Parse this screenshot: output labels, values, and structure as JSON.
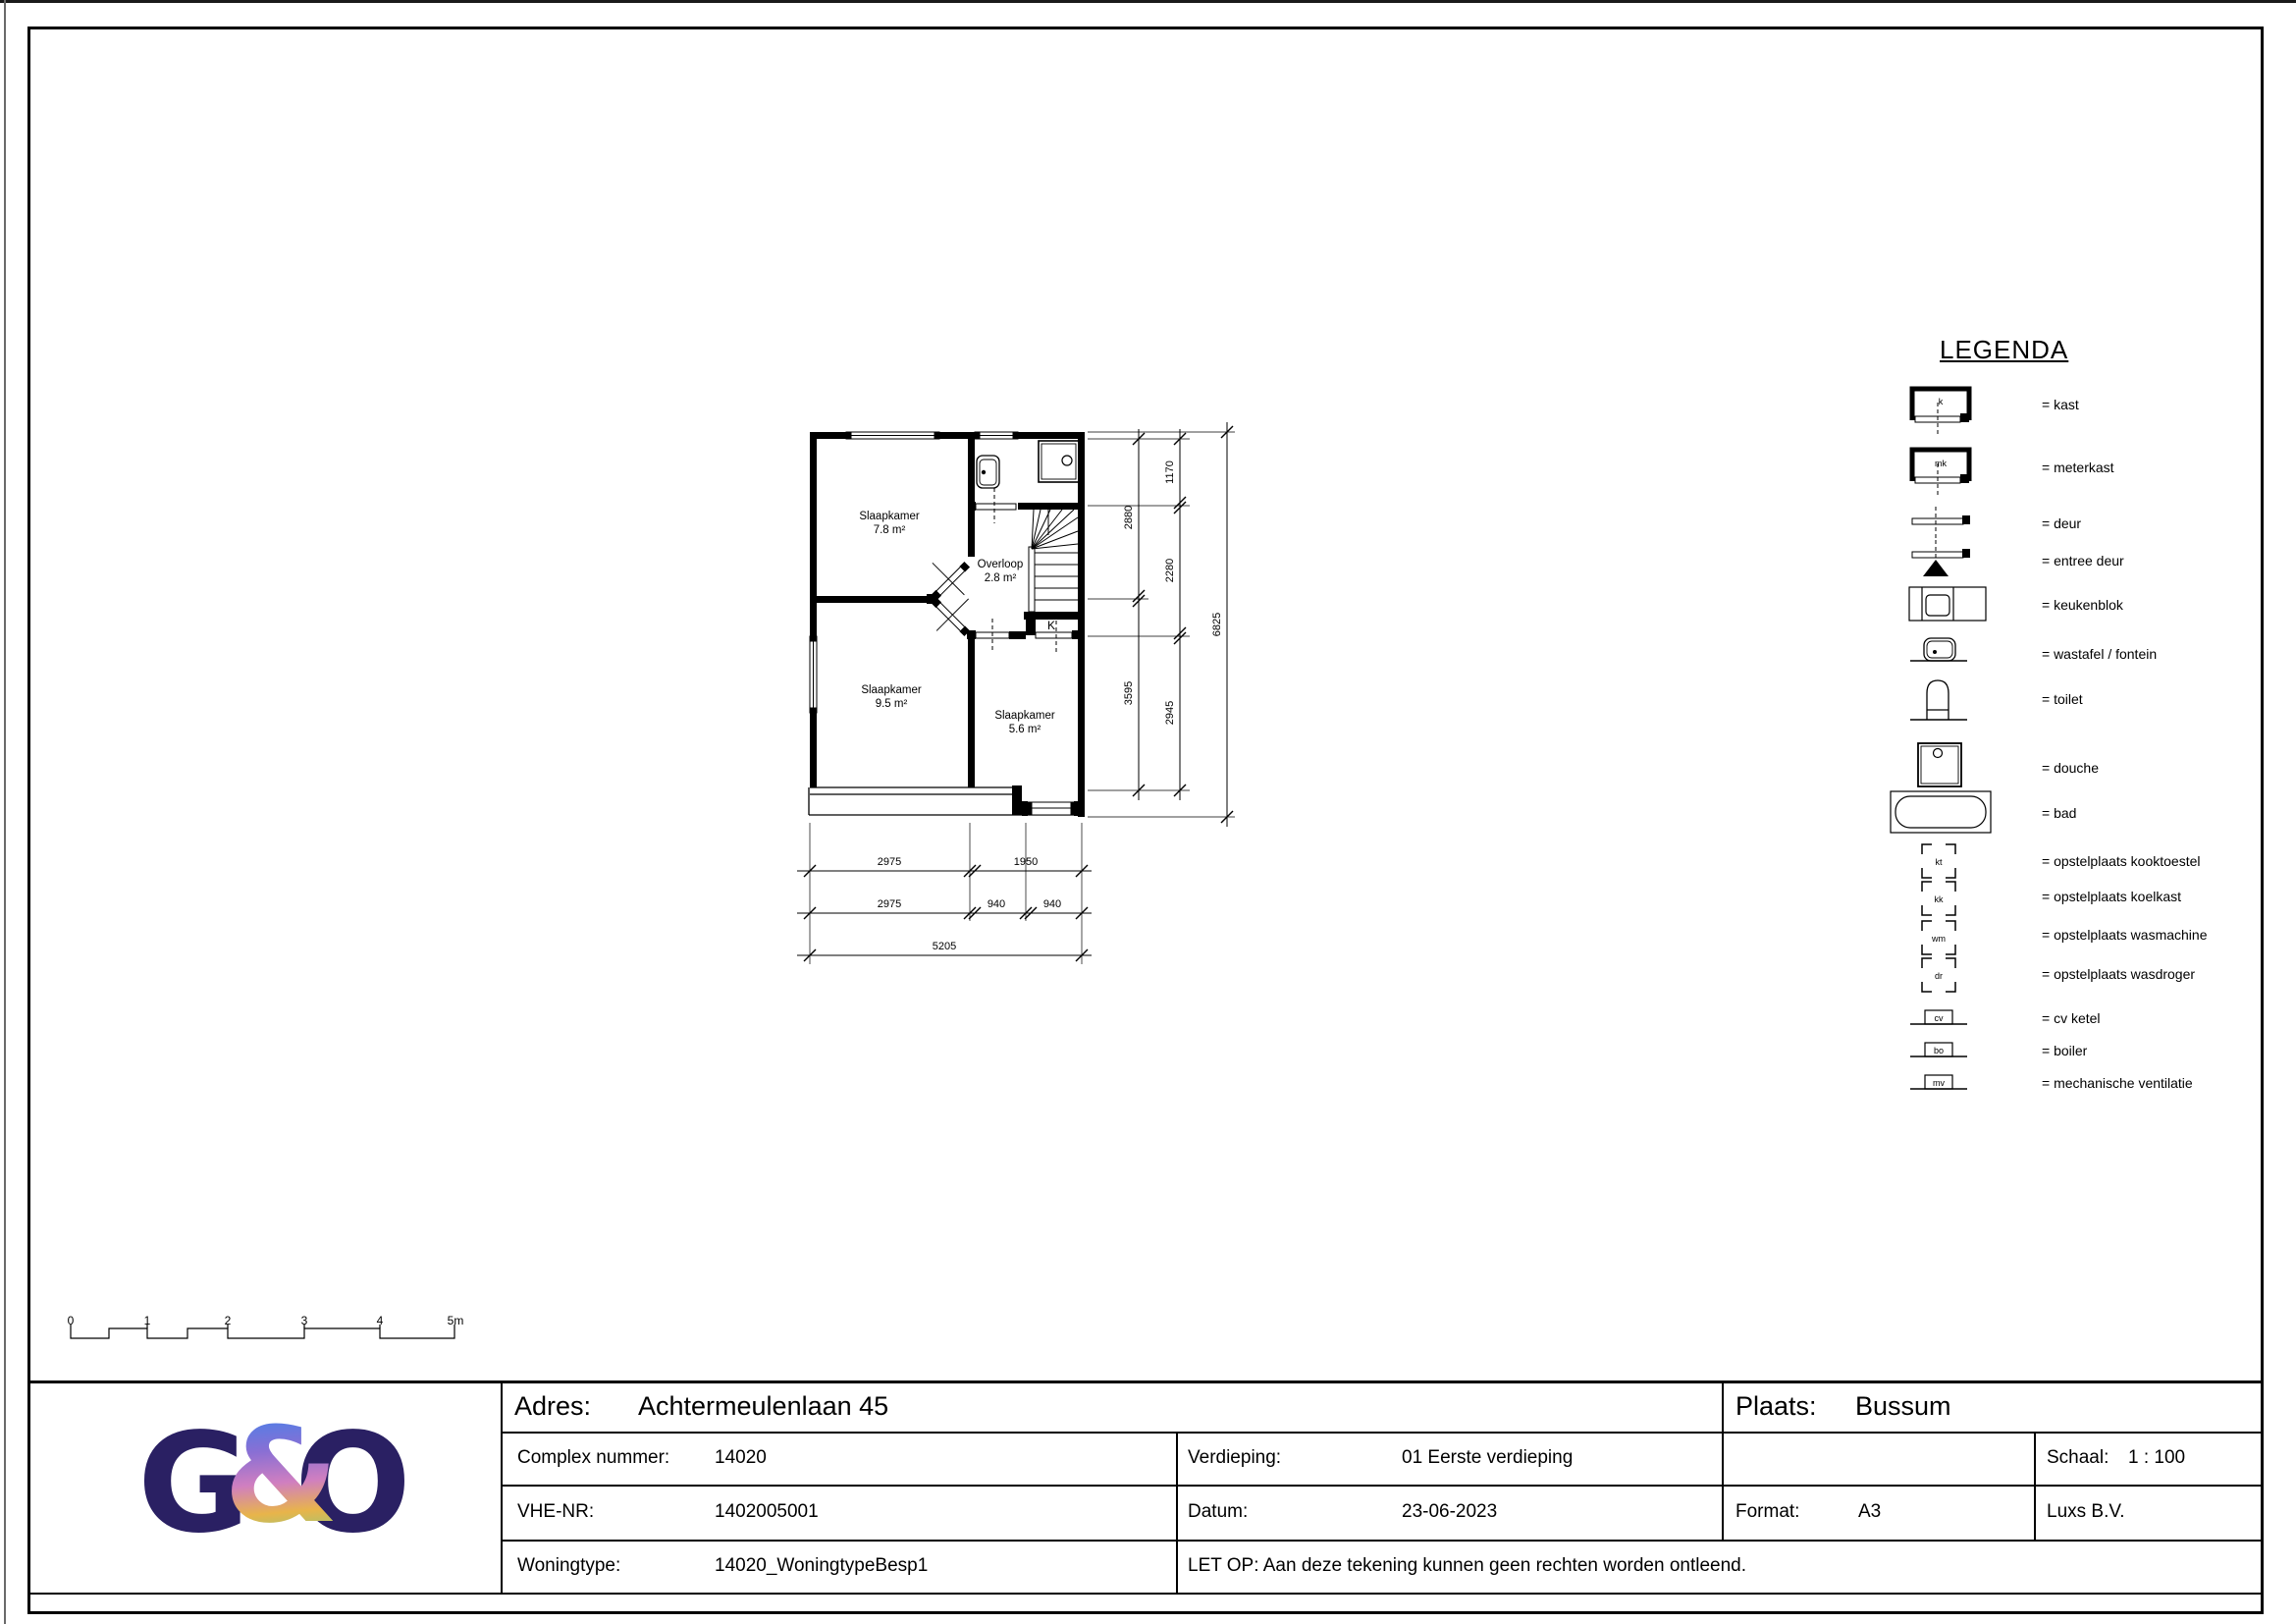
{
  "colors": {
    "ink": "#000000",
    "logo_navy": "#2a2063",
    "amp_gradient": [
      "#4a80e8",
      "#8a6fd4",
      "#d07fc0",
      "#e8b44a",
      "#97c87a"
    ]
  },
  "legend": {
    "title": "LEGENDA",
    "items": [
      {
        "symbol": "kast",
        "key": "k",
        "label": "= kast"
      },
      {
        "symbol": "meterkast",
        "key": "mk",
        "label": "= meterkast"
      },
      {
        "symbol": "deur",
        "key": "",
        "label": "= deur"
      },
      {
        "symbol": "entree-deur",
        "key": "",
        "label": "= entree deur"
      },
      {
        "symbol": "keukenblok",
        "key": "",
        "label": "= keukenblok"
      },
      {
        "symbol": "wastafel",
        "key": "",
        "label": "= wastafel / fontein"
      },
      {
        "symbol": "toilet",
        "key": "",
        "label": "= toilet"
      },
      {
        "symbol": "douche",
        "key": "",
        "label": "= douche"
      },
      {
        "symbol": "bad",
        "key": "",
        "label": "= bad"
      },
      {
        "symbol": "kooktoestel",
        "key": "kt",
        "label": "= opstelplaats kooktoestel"
      },
      {
        "symbol": "koelkast",
        "key": "kk",
        "label": "= opstelplaats koelkast"
      },
      {
        "symbol": "wasmachine",
        "key": "wm",
        "label": "= opstelplaats wasmachine"
      },
      {
        "symbol": "wasdroger",
        "key": "dr",
        "label": "= opstelplaats wasdroger"
      },
      {
        "symbol": "cv-ketel",
        "key": "cv",
        "label": "= cv ketel"
      },
      {
        "symbol": "boiler",
        "key": "bo",
        "label": "= boiler"
      },
      {
        "symbol": "mech-ventilatie",
        "key": "mv",
        "label": "= mechanische ventilatie"
      }
    ]
  },
  "plan": {
    "rooms": [
      {
        "name": "Slaapkamer",
        "area": "7.8 m²"
      },
      {
        "name": "Slaapkamer",
        "area": "9.5 m²"
      },
      {
        "name": "Slaapkamer",
        "area": "5.6 m²"
      },
      {
        "name": "Overloop",
        "area": "2.8 m²"
      }
    ],
    "closet_label": "K",
    "dims": {
      "bottom": [
        [
          "2975",
          "1950"
        ],
        [
          "2975",
          "940",
          "940"
        ],
        [
          "5205"
        ]
      ],
      "right": [
        [
          "2880",
          "3595"
        ],
        [
          "1170",
          "2280",
          "2945"
        ],
        [
          "6825"
        ]
      ]
    }
  },
  "scalebar": {
    "ticks": [
      "0",
      "1",
      "2",
      "3",
      "4",
      "5m"
    ]
  },
  "logo": {
    "g": "G",
    "amp": "&",
    "o": "O"
  },
  "titleblock": {
    "adres_label": "Adres:",
    "adres_value": "Achtermeulenlaan 45",
    "plaats_label": "Plaats:",
    "plaats_value": "Bussum",
    "complex_label": "Complex nummer:",
    "complex_value": "14020",
    "verdieping_label": "Verdieping:",
    "verdieping_value": "01 Eerste verdieping",
    "schaal_label": "Schaal:",
    "schaal_value": "1 : 100",
    "vhe_label": "VHE-NR:",
    "vhe_value": "1402005001",
    "datum_label": "Datum:",
    "datum_value": "23-06-2023",
    "format_label": "Format:",
    "format_value": "A3",
    "bedrijf": "Luxs B.V.",
    "woningtype_label": "Woningtype:",
    "woningtype_value": "14020_WoningtypeBesp1",
    "letop": "LET OP: Aan deze tekening kunnen geen rechten worden ontleend."
  }
}
